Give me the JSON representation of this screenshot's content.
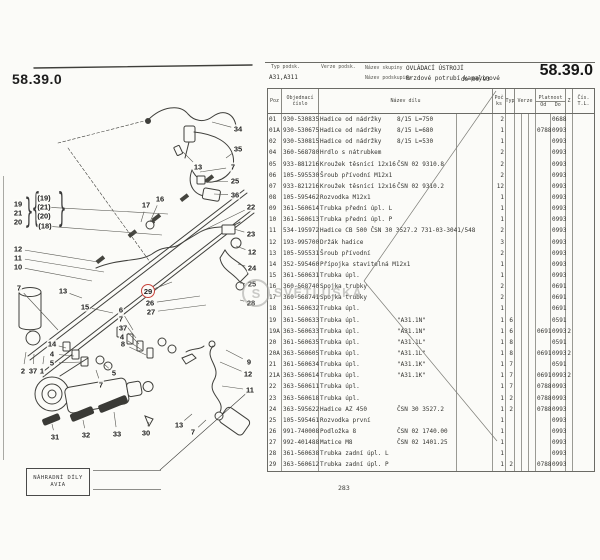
{
  "page": {
    "code_left": "58.39.0",
    "code_right": "58.39.0",
    "page_number": "283",
    "stamp_box": {
      "line1": "NÁHRADNÍ DÍLY",
      "line2": "AVIA"
    },
    "watermark": {
      "initial": "S",
      "text": "SVĚTLUŠKA"
    }
  },
  "info_header": {
    "typ_podsk_label": "Typ podsk.",
    "typ_podsk_value": "A31,A311",
    "verze_podsk_label": "Verze podsk.",
    "nazev_skupiny_label": "Název skupiny",
    "nazev_skupiny_value": "OVLÁDACÍ ÚSTROJÍ",
    "nazev_podskupiny_label": "Název podskupiny",
    "nazev_podskupiny_value": "Brzdové potrubí kapalinové",
    "validity": "do 09/93"
  },
  "table": {
    "columns": {
      "poz": "Poz",
      "cislo_1": "Objednací",
      "cislo_2": "číslo",
      "nazev": "Název dílu",
      "ks_1": "Poč",
      "ks_2": "ks",
      "typ": "Typ",
      "verze": "Verze",
      "platnost": "Platnost",
      "od": "Od",
      "do": "Do",
      "z": "Z",
      "tl_1": "Čís.",
      "tl_2": "T.L."
    },
    "rows": [
      {
        "poz": "01",
        "cislo": "930-530835",
        "nazev": "Hadice od nádržky",
        "note": "8/15 L=750",
        "ks": "2",
        "typ": "",
        "od": "",
        "do": "0688",
        "z": ""
      },
      {
        "poz": "01A",
        "cislo": "930-530675",
        "nazev": "Hadice od nádržky",
        "note": "8/15 L=680",
        "ks": "1",
        "typ": "",
        "od": "0788",
        "do": "0993",
        "z": ""
      },
      {
        "poz": "02",
        "cislo": "930-530815",
        "nazev": "Hadice od nádržky",
        "note": "8/15 L=530",
        "ks": "1",
        "typ": "",
        "od": "",
        "do": "0993",
        "z": ""
      },
      {
        "poz": "04",
        "cislo": "360-568780",
        "nazev": "Hrdlo s nátrubkem",
        "note": "",
        "ks": "2",
        "typ": "",
        "od": "",
        "do": "0993",
        "z": ""
      },
      {
        "poz": "05",
        "cislo": "933-881216",
        "nazev": "Kroužek těsnící 12x16",
        "note": "ČSN 02 9310.8",
        "ks": "2",
        "typ": "",
        "od": "",
        "do": "0993",
        "z": ""
      },
      {
        "poz": "06",
        "cislo": "105-595530",
        "nazev": "Šroub přívodní M12x1",
        "note": "",
        "ks": "2",
        "typ": "",
        "od": "",
        "do": "0993",
        "z": ""
      },
      {
        "poz": "07",
        "cislo": "933-821216",
        "nazev": "Kroužek těsnící 12x16",
        "note": "ČSN 02 9310.2",
        "ks": "12",
        "typ": "",
        "od": "",
        "do": "0993",
        "z": ""
      },
      {
        "poz": "08",
        "cislo": "105-595462",
        "nazev": "Rozvodka M12x1",
        "note": "",
        "ks": "1",
        "typ": "",
        "od": "",
        "do": "0993",
        "z": ""
      },
      {
        "poz": "09",
        "cislo": "361-560614",
        "nazev": "Trubka přední úpl. L",
        "note": "",
        "ks": "1",
        "typ": "",
        "od": "",
        "do": "0993",
        "z": ""
      },
      {
        "poz": "10",
        "cislo": "361-560613",
        "nazev": "Trubka přední úpl. P",
        "note": "",
        "ks": "1",
        "typ": "",
        "od": "",
        "do": "0993",
        "z": ""
      },
      {
        "poz": "11",
        "cislo": "534-195972",
        "nazev": "Hadice CB 500 ČSN 30 3527.2  731-03-3041/548",
        "note": "",
        "ks": "2",
        "typ": "",
        "od": "",
        "do": "0993",
        "z": ""
      },
      {
        "poz": "12",
        "cislo": "193-995700",
        "nazev": "Držák hadice",
        "note": "",
        "ks": "3",
        "typ": "",
        "od": "",
        "do": "0993",
        "z": ""
      },
      {
        "poz": "13",
        "cislo": "105-595531",
        "nazev": "Šroub přívodní",
        "note": "",
        "ks": "2",
        "typ": "",
        "od": "",
        "do": "0993",
        "z": ""
      },
      {
        "poz": "14",
        "cislo": "352-595460",
        "nazev": "Přípojka stavitelná M12x1",
        "note": "",
        "ks": "1",
        "typ": "",
        "od": "",
        "do": "0993",
        "z": ""
      },
      {
        "poz": "15",
        "cislo": "361-560631",
        "nazev": "Trubka úpl.",
        "note": "",
        "ks": "1",
        "typ": "",
        "od": "",
        "do": "0993",
        "z": ""
      },
      {
        "poz": "16",
        "cislo": "360-568740",
        "nazev": "Spojka trubky",
        "note": "",
        "ks": "2",
        "typ": "",
        "od": "",
        "do": "0691",
        "z": ""
      },
      {
        "poz": "17",
        "cislo": "360-568741",
        "nazev": "Spojka trubky",
        "note": "",
        "ks": "2",
        "typ": "",
        "od": "",
        "do": "0691",
        "z": ""
      },
      {
        "poz": "18",
        "cislo": "361-560632",
        "nazev": "Trubka úpl.",
        "note": "",
        "ks": "1",
        "typ": "",
        "od": "",
        "do": "0691",
        "z": ""
      },
      {
        "poz": "19",
        "cislo": "361-560633",
        "nazev": "Trubka úpl.",
        "note": "\"A31.1N\"",
        "ks": "1",
        "typ": "6",
        "od": "",
        "do": "0591",
        "z": ""
      },
      {
        "poz": "19A",
        "cislo": "363-560633",
        "nazev": "Trubka úpl.",
        "note": "\"A31.1N\"",
        "ks": "1",
        "typ": "6",
        "od": "0691",
        "do": "0993",
        "z": "2"
      },
      {
        "poz": "20",
        "cislo": "361-560635",
        "nazev": "Trubka úpl.",
        "note": "\"A31.1L\"",
        "ks": "1",
        "typ": "8",
        "od": "",
        "do": "0591",
        "z": ""
      },
      {
        "poz": "20A",
        "cislo": "363-560605",
        "nazev": "Trubka úpl.",
        "note": "\"A31.1L\"",
        "ks": "1",
        "typ": "8",
        "od": "0691",
        "do": "0993",
        "z": "2"
      },
      {
        "poz": "21",
        "cislo": "361-560634",
        "nazev": "Trubka úpl.",
        "note": "\"A31.1K\"",
        "ks": "1",
        "typ": "7",
        "od": "",
        "do": "0591",
        "z": ""
      },
      {
        "poz": "21A",
        "cislo": "363-560614",
        "nazev": "Trubka úpl.",
        "note": "\"A31.1K\"",
        "ks": "1",
        "typ": "7",
        "od": "0691",
        "do": "0993",
        "z": "2"
      },
      {
        "poz": "22",
        "cislo": "363-560611",
        "nazev": "Trubka úpl.",
        "note": "",
        "ks": "1",
        "typ": "7",
        "od": "0788",
        "do": "0993",
        "z": ""
      },
      {
        "poz": "23",
        "cislo": "363-560618",
        "nazev": "Trubka úpl.",
        "note": "",
        "ks": "1",
        "typ": "2",
        "od": "0788",
        "do": "0993",
        "z": ""
      },
      {
        "poz": "24",
        "cislo": "363-595622",
        "nazev": "Hadice AZ 450",
        "note": "ČSN 30 3527.2",
        "ks": "1",
        "typ": "2",
        "od": "0788",
        "do": "0993",
        "z": ""
      },
      {
        "poz": "25",
        "cislo": "105-595461",
        "nazev": "Rozvodka první",
        "note": "",
        "ks": "1",
        "typ": "",
        "od": "",
        "do": "0993",
        "z": ""
      },
      {
        "poz": "26",
        "cislo": "991-740008",
        "nazev": "Podložka 8",
        "note": "ČSN 02 1740.00",
        "ks": "1",
        "typ": "",
        "od": "",
        "do": "0993",
        "z": ""
      },
      {
        "poz": "27",
        "cislo": "992-401488",
        "nazev": "Matice M8",
        "note": "ČSN 02 1401.25",
        "ks": "1",
        "typ": "",
        "od": "",
        "do": "0993",
        "z": ""
      },
      {
        "poz": "28",
        "cislo": "361-560638",
        "nazev": "Trubka zadní úpl. L",
        "note": "",
        "ks": "1",
        "typ": "",
        "od": "",
        "do": "0993",
        "z": ""
      },
      {
        "poz": "29",
        "cislo": "363-560612",
        "nazev": "Trubka zadní úpl. P",
        "note": "",
        "ks": "1",
        "typ": "2",
        "od": "0788",
        "do": "0993",
        "z": ""
      }
    ]
  },
  "diagram": {
    "callouts": [
      {
        "label": "34",
        "x": 238,
        "y": 129,
        "tx": 212,
        "ty": 122
      },
      {
        "label": "35",
        "x": 238,
        "y": 149,
        "tx": 226,
        "ty": 158
      },
      {
        "label": "13",
        "x": 198,
        "y": 167,
        "tx": 183,
        "ty": 152
      },
      {
        "label": "7",
        "x": 233,
        "y": 167,
        "tx": 200,
        "ty": 172
      },
      {
        "label": "25",
        "x": 235,
        "y": 181,
        "tx": 206,
        "ty": 182
      },
      {
        "label": "36",
        "x": 235,
        "y": 195,
        "tx": 214,
        "ty": 194
      },
      {
        "label": "16",
        "x": 160,
        "y": 199,
        "tx": 150,
        "ty": 222
      },
      {
        "label": "17",
        "x": 146,
        "y": 205,
        "tx": 141,
        "ty": 222
      },
      {
        "label": "22",
        "x": 251,
        "y": 207,
        "tx": 196,
        "ty": 234
      },
      {
        "label": "23",
        "x": 251,
        "y": 234,
        "tx": 234,
        "ty": 229
      },
      {
        "label": "12",
        "x": 252,
        "y": 252,
        "tx": 236,
        "ty": 246
      },
      {
        "label": "24",
        "x": 252,
        "y": 268,
        "tx": 238,
        "ty": 264
      },
      {
        "label": "25",
        "x": 252,
        "y": 284,
        "tx": 240,
        "ty": 283
      },
      {
        "label": "28",
        "x": 251,
        "y": 303,
        "tx": 240,
        "ty": 300
      },
      {
        "label": "19",
        "x": 18,
        "y": 204
      },
      {
        "label": "21",
        "x": 18,
        "y": 213
      },
      {
        "label": "20",
        "x": 18,
        "y": 222
      },
      {
        "label": "(19)",
        "x": 44,
        "y": 198
      },
      {
        "label": "(21)",
        "x": 44,
        "y": 207,
        "tx": 168,
        "ty": 214
      },
      {
        "label": "(20)",
        "x": 44,
        "y": 216
      },
      {
        "label": "(18)",
        "x": 45,
        "y": 226,
        "tx": 162,
        "ty": 235
      },
      {
        "label": "12",
        "x": 18,
        "y": 249,
        "tx": 98,
        "ty": 262
      },
      {
        "label": "11",
        "x": 18,
        "y": 258,
        "tx": 104,
        "ty": 272
      },
      {
        "label": "10",
        "x": 18,
        "y": 267,
        "tx": 92,
        "ty": 281
      },
      {
        "label": "7",
        "x": 19,
        "y": 288,
        "tx": 58,
        "ty": 330
      },
      {
        "label": "13",
        "x": 63,
        "y": 291,
        "tx": 82,
        "ty": 298
      },
      {
        "label": "29",
        "x": 148,
        "y": 291,
        "circled": true,
        "tx": 172,
        "ty": 282
      },
      {
        "label": "26",
        "x": 150,
        "y": 303,
        "tx": 200,
        "ty": 296
      },
      {
        "label": "27",
        "x": 151,
        "y": 312,
        "tx": 206,
        "ty": 305
      },
      {
        "label": "15",
        "x": 85,
        "y": 307,
        "tx": 113,
        "ty": 313
      },
      {
        "label": "6",
        "x": 121,
        "y": 310,
        "tx": 133,
        "ty": 330
      },
      {
        "label": "7",
        "x": 121,
        "y": 319,
        "tx": 136,
        "ty": 338
      },
      {
        "label": "37",
        "x": 123,
        "y": 328,
        "tx": 139,
        "ty": 344
      },
      {
        "label": "4",
        "x": 122,
        "y": 337,
        "tx": 142,
        "ty": 350
      },
      {
        "label": "8",
        "x": 123,
        "y": 344,
        "tx": 146,
        "ty": 355
      },
      {
        "label": "14",
        "x": 52,
        "y": 344,
        "tx": 66,
        "ty": 348
      },
      {
        "label": "4",
        "x": 52,
        "y": 354,
        "tx": 74,
        "ty": 356
      },
      {
        "label": "5",
        "x": 52,
        "y": 363,
        "tx": 82,
        "ty": 362
      },
      {
        "label": "2",
        "x": 23,
        "y": 371,
        "tx": 26,
        "ty": 352
      },
      {
        "label": "37",
        "x": 33,
        "y": 371,
        "tx": 34,
        "ty": 354
      },
      {
        "label": "1",
        "x": 42,
        "y": 371,
        "tx": 44,
        "ty": 356
      },
      {
        "label": "5",
        "x": 114,
        "y": 373,
        "tx": 104,
        "ty": 364
      },
      {
        "label": "7",
        "x": 101,
        "y": 385,
        "tx": 96,
        "ty": 370
      },
      {
        "label": "9",
        "x": 249,
        "y": 362,
        "tx": 226,
        "ty": 350
      },
      {
        "label": "12",
        "x": 248,
        "y": 374,
        "tx": 220,
        "ty": 362
      },
      {
        "label": "11",
        "x": 250,
        "y": 390,
        "tx": 222,
        "ty": 386
      },
      {
        "label": "13",
        "x": 179,
        "y": 425,
        "tx": 192,
        "ty": 414
      },
      {
        "label": "7",
        "x": 193,
        "y": 432,
        "tx": 206,
        "ty": 420
      },
      {
        "label": "31",
        "x": 55,
        "y": 437,
        "tx": 52,
        "ty": 424
      },
      {
        "label": "32",
        "x": 86,
        "y": 435,
        "tx": 83,
        "ty": 420
      },
      {
        "label": "33",
        "x": 117,
        "y": 434,
        "tx": 114,
        "ty": 412
      },
      {
        "label": "30",
        "x": 146,
        "y": 433,
        "tx": 149,
        "ty": 422
      }
    ],
    "braces": [
      {
        "ch": "}",
        "x": 29,
        "y": 213,
        "sy": 2.4
      },
      {
        "ch": "{",
        "x": 36,
        "y": 210,
        "sy": 2.8
      },
      {
        "ch": "}",
        "x": 62,
        "y": 210,
        "sy": 2.8
      }
    ]
  },
  "colors": {
    "accent_red": "#c8423a",
    "ink": "#2c2c2c",
    "paper": "#fbfbf8",
    "watermark_grey": "#a2a29e"
  }
}
